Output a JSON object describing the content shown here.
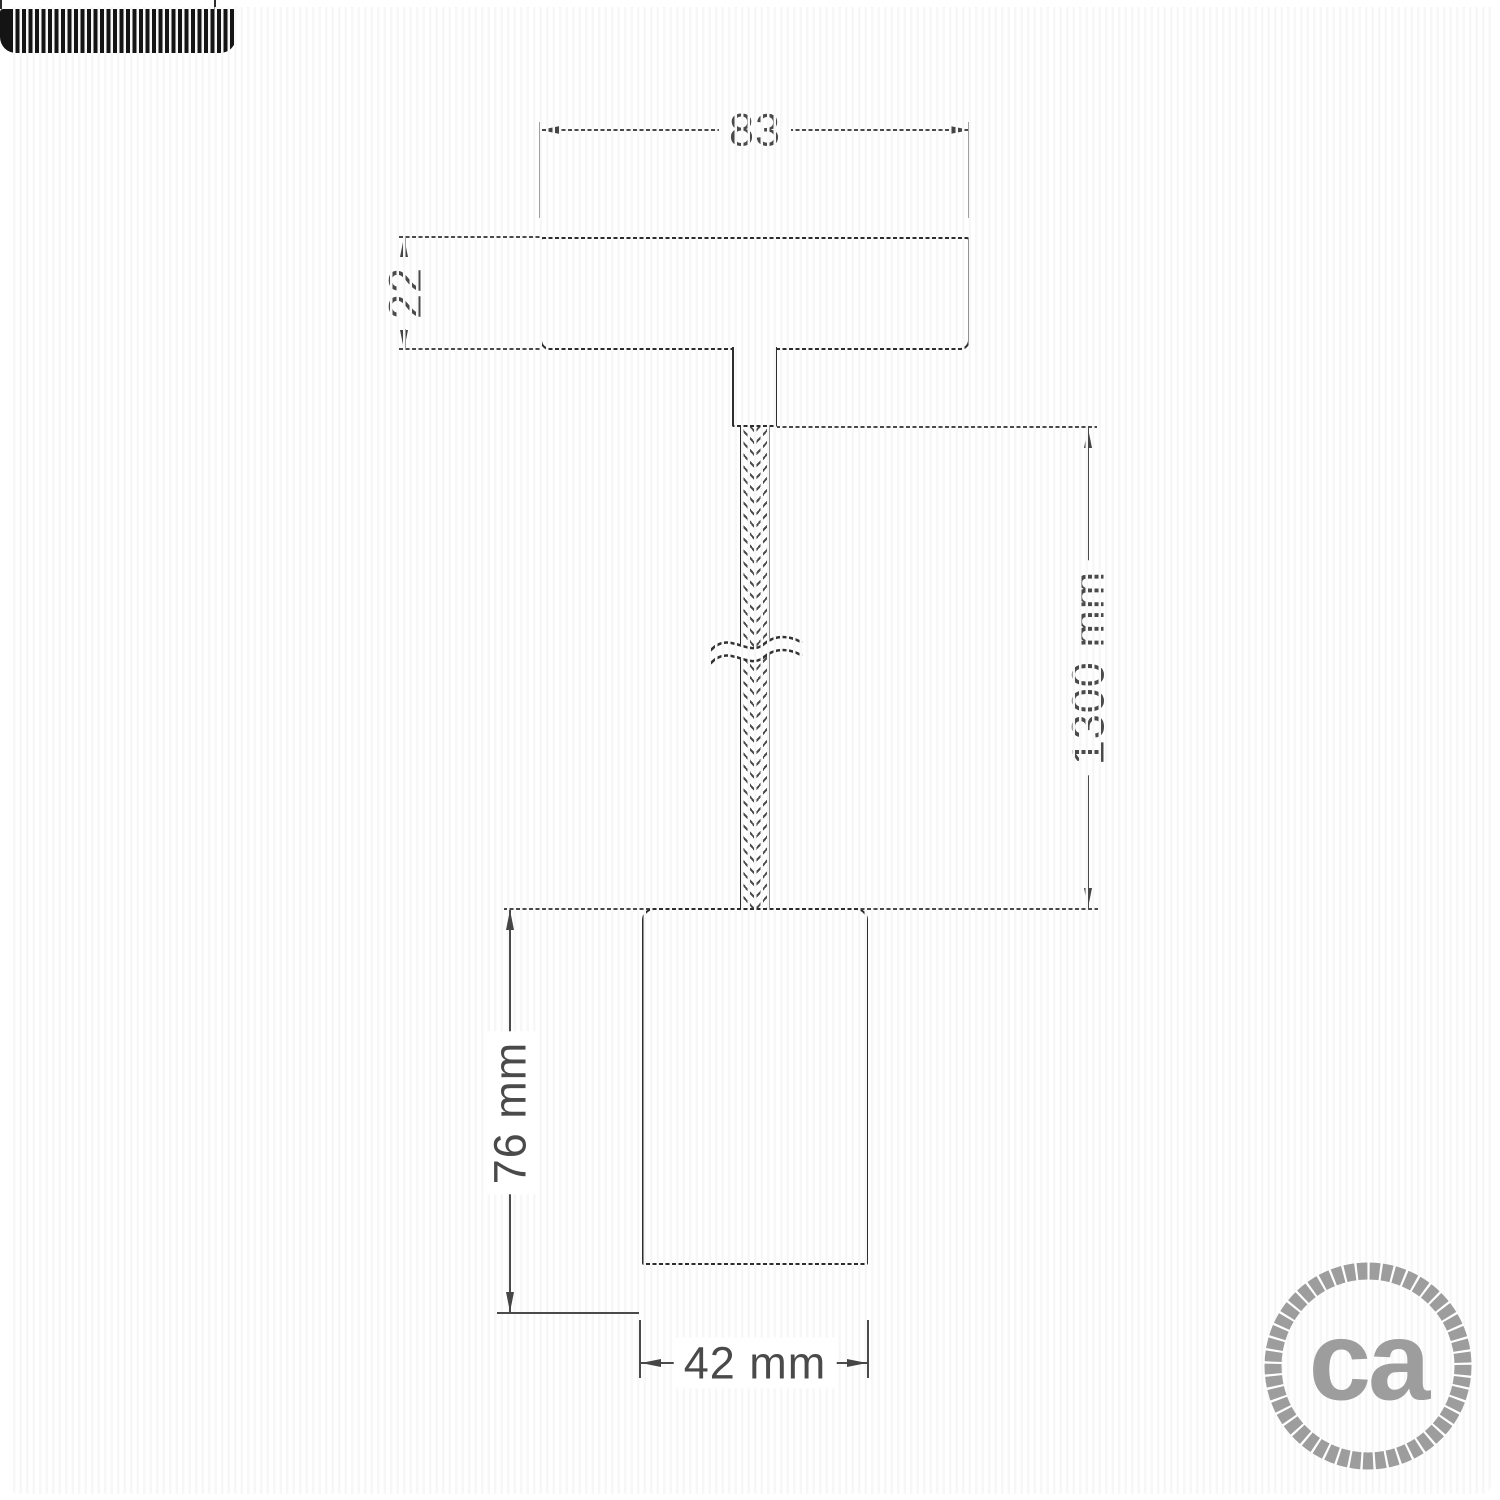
{
  "drawing": {
    "kind": "pendant-spotlight-technical-drawing",
    "dimensions": {
      "canopy_width": "83",
      "canopy_height": "22",
      "cable_length": "1300 mm",
      "spot_height": "76 mm",
      "spot_diameter": "42 mm"
    }
  },
  "logo": {
    "text": "ca"
  },
  "colors": {
    "object_line": "#2d2d2d",
    "dimension_line": "#4a4a4a",
    "ring_black": "#141414",
    "logo_gray": "#9d9d9d",
    "background": "#ffffff"
  }
}
